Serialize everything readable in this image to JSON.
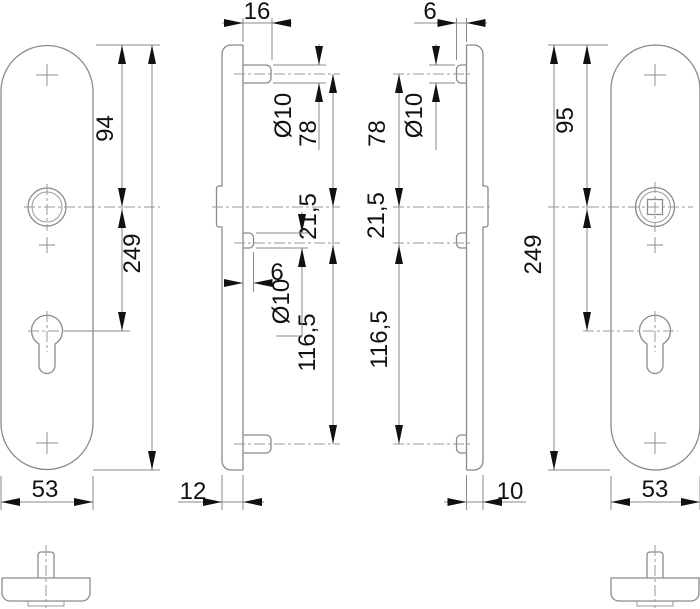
{
  "drawing": {
    "kind": "technical-dimension-drawing",
    "background_color": "#ffffff",
    "line_color": "#8a8a8a",
    "annotation_color": "#111111",
    "views": {
      "left_plate": {
        "label": "left-plate-front-view",
        "dims": {
          "top_to_handle": "94",
          "total_height": "249",
          "width": "53"
        }
      },
      "profile_left": {
        "label": "outer-plate-side-profile",
        "dims": {
          "depth_overall": "16",
          "top_stud_dia": "Ø10",
          "stud_to_handle": "78",
          "handle_to_cyl_stud": "21,5",
          "mid_stud_len": "6",
          "mid_stud_dia": "Ø10",
          "cyl_to_bottom_stud": "116,5",
          "thickness": "12"
        }
      },
      "profile_right": {
        "label": "inner-plate-side-profile",
        "dims": {
          "stud_len": "6",
          "top_stud_dia": "Ø10",
          "stud_to_handle": "78",
          "handle_to_cyl_stud": "21,5",
          "cyl_to_bottom_stud": "116,5",
          "thickness": "10"
        }
      },
      "right_plate": {
        "label": "right-plate-front-view",
        "dims": {
          "top_to_spindle": "95",
          "total_height": "249",
          "width": "53"
        }
      }
    }
  }
}
